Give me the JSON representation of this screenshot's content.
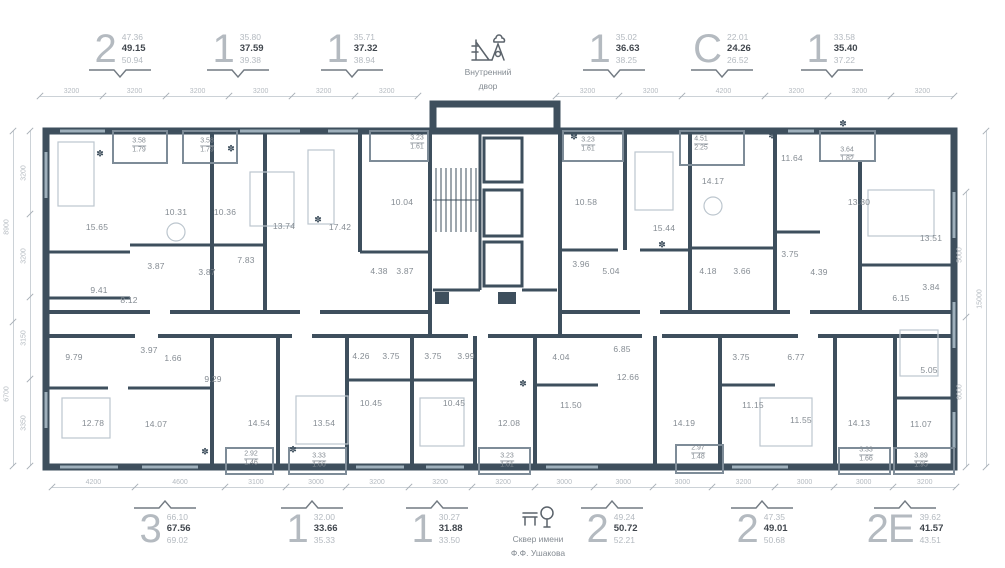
{
  "colors": {
    "wall": "#3e4f5d",
    "window": "#9fb0bc",
    "dim_line": "#ccd2d7",
    "dim_text": "#b5bbc1",
    "room_text": "#858c93",
    "unit_digit": "#b4bac0",
    "unit_bold": "#41474e"
  },
  "plant_glyph": "✽",
  "courtyard": {
    "line1": "Внутренний",
    "line2": "двор"
  },
  "park": {
    "line1": "Сквер имени",
    "line2": "Ф.Ф. Ушакова"
  },
  "top_units": [
    {
      "type": "2",
      "values": [
        "47.36",
        "49.15",
        "50.94"
      ],
      "x": 120
    },
    {
      "type": "1",
      "values": [
        "35.80",
        "37.59",
        "39.38"
      ],
      "x": 238
    },
    {
      "type": "1",
      "values": [
        "35.71",
        "37.32",
        "38.94"
      ],
      "x": 352
    },
    {
      "type": "1",
      "values": [
        "35.02",
        "36.63",
        "38.25"
      ],
      "x": 614
    },
    {
      "type": "С",
      "values": [
        "22.01",
        "24.26",
        "26.52"
      ],
      "x": 722
    },
    {
      "type": "1",
      "values": [
        "33.58",
        "35.40",
        "37.22"
      ],
      "x": 832
    }
  ],
  "bottom_units": [
    {
      "type": "3",
      "values": [
        "66.10",
        "67.56",
        "69.02"
      ],
      "x": 165
    },
    {
      "type": "1",
      "values": [
        "32.00",
        "33.66",
        "35.33"
      ],
      "x": 312
    },
    {
      "type": "1",
      "values": [
        "30.27",
        "31.88",
        "33.50"
      ],
      "x": 437
    },
    {
      "type": "2",
      "values": [
        "49.24",
        "50.72",
        "52.21"
      ],
      "x": 612
    },
    {
      "type": "2",
      "values": [
        "47.35",
        "49.01",
        "50.68"
      ],
      "x": 762
    },
    {
      "type": "2Е",
      "values": [
        "39.62",
        "41.57",
        "43.51"
      ],
      "x": 905
    }
  ],
  "rooms": [
    {
      "v": "15.65",
      "x": 97,
      "y": 227
    },
    {
      "v": "10.31",
      "x": 176,
      "y": 212
    },
    {
      "v": "10.36",
      "x": 225,
      "y": 212
    },
    {
      "v": "3.87",
      "x": 156,
      "y": 266
    },
    {
      "v": "3.87",
      "x": 207,
      "y": 272
    },
    {
      "v": "7.83",
      "x": 246,
      "y": 260
    },
    {
      "v": "9.41",
      "x": 99,
      "y": 290
    },
    {
      "v": "8.12",
      "x": 129,
      "y": 300
    },
    {
      "v": "13.74",
      "x": 284,
      "y": 226
    },
    {
      "v": "17.42",
      "x": 340,
      "y": 227
    },
    {
      "v": "10.04",
      "x": 402,
      "y": 202
    },
    {
      "v": "4.38",
      "x": 379,
      "y": 271
    },
    {
      "v": "3.87",
      "x": 405,
      "y": 271
    },
    {
      "v": "10.58",
      "x": 586,
      "y": 202
    },
    {
      "v": "15.44",
      "x": 664,
      "y": 228
    },
    {
      "v": "3.96",
      "x": 581,
      "y": 264
    },
    {
      "v": "5.04",
      "x": 611,
      "y": 271
    },
    {
      "v": "14.17",
      "x": 713,
      "y": 181
    },
    {
      "v": "4.18",
      "x": 708,
      "y": 271
    },
    {
      "v": "3.66",
      "x": 742,
      "y": 271
    },
    {
      "v": "3.75",
      "x": 790,
      "y": 254
    },
    {
      "v": "4.39",
      "x": 819,
      "y": 272
    },
    {
      "v": "11.64",
      "x": 792,
      "y": 158
    },
    {
      "v": "13.80",
      "x": 859,
      "y": 202
    },
    {
      "v": "13.51",
      "x": 931,
      "y": 238
    },
    {
      "v": "3.84",
      "x": 931,
      "y": 287
    },
    {
      "v": "6.15",
      "x": 901,
      "y": 298
    },
    {
      "v": "9.79",
      "x": 74,
      "y": 357
    },
    {
      "v": "3.97",
      "x": 149,
      "y": 350
    },
    {
      "v": "1.66",
      "x": 173,
      "y": 358
    },
    {
      "v": "9.29",
      "x": 213,
      "y": 379
    },
    {
      "v": "12.78",
      "x": 93,
      "y": 423
    },
    {
      "v": "14.07",
      "x": 156,
      "y": 424
    },
    {
      "v": "14.54",
      "x": 259,
      "y": 423
    },
    {
      "v": "13.54",
      "x": 324,
      "y": 423
    },
    {
      "v": "4.26",
      "x": 361,
      "y": 356
    },
    {
      "v": "3.75",
      "x": 391,
      "y": 356
    },
    {
      "v": "3.75",
      "x": 433,
      "y": 356
    },
    {
      "v": "3.99",
      "x": 466,
      "y": 356
    },
    {
      "v": "10.45",
      "x": 371,
      "y": 403
    },
    {
      "v": "10.45",
      "x": 454,
      "y": 403
    },
    {
      "v": "12.08",
      "x": 509,
      "y": 423
    },
    {
      "v": "4.04",
      "x": 561,
      "y": 357
    },
    {
      "v": "11.50",
      "x": 571,
      "y": 405
    },
    {
      "v": "6.85",
      "x": 622,
      "y": 349
    },
    {
      "v": "12.66",
      "x": 628,
      "y": 377
    },
    {
      "v": "14.19",
      "x": 684,
      "y": 423
    },
    {
      "v": "3.75",
      "x": 741,
      "y": 357
    },
    {
      "v": "11.15",
      "x": 753,
      "y": 405
    },
    {
      "v": "6.77",
      "x": 796,
      "y": 357
    },
    {
      "v": "11.55",
      "x": 801,
      "y": 420
    },
    {
      "v": "14.13",
      "x": 859,
      "y": 423
    },
    {
      "v": "5.05",
      "x": 929,
      "y": 370
    },
    {
      "v": "11.07",
      "x": 921,
      "y": 424
    }
  ],
  "balconies": [
    {
      "t": "3.58",
      "b": "1.79",
      "x": 139,
      "y": 146
    },
    {
      "t": "3.58",
      "b": "1.79",
      "x": 207,
      "y": 146
    },
    {
      "t": "3.23",
      "b": "1.61",
      "x": 417,
      "y": 143
    },
    {
      "t": "3.23",
      "b": "1.61",
      "x": 588,
      "y": 145
    },
    {
      "t": "4.51",
      "b": "2.25",
      "x": 701,
      "y": 144
    },
    {
      "t": "3.64",
      "b": "1.82",
      "x": 847,
      "y": 155
    },
    {
      "t": "2.92",
      "b": "1.46",
      "x": 251,
      "y": 459
    },
    {
      "t": "3.33",
      "b": "1.66",
      "x": 319,
      "y": 461
    },
    {
      "t": "3.23",
      "b": "1.61",
      "x": 507,
      "y": 461
    },
    {
      "t": "2.97",
      "b": "1.48",
      "x": 698,
      "y": 453
    },
    {
      "t": "3.33",
      "b": "1.66",
      "x": 866,
      "y": 455
    },
    {
      "t": "3.89",
      "b": "1.95",
      "x": 921,
      "y": 461
    }
  ],
  "dim_chains": [
    {
      "name": "top-left",
      "dir": "h",
      "x": 40,
      "y": 96,
      "scale": 0.0197,
      "values": [
        3200,
        3200,
        3200,
        3200,
        3200,
        3200
      ]
    },
    {
      "name": "top-right",
      "dir": "h",
      "x": 556,
      "y": 96,
      "scale": 0.0197,
      "values": [
        3200,
        3200,
        4200,
        3200,
        3200,
        3200
      ]
    },
    {
      "name": "bottom",
      "dir": "h",
      "x": 52,
      "y": 487,
      "scale": 0.0197,
      "values": [
        4200,
        4600,
        3100,
        3000,
        3200,
        3200,
        3200,
        3000,
        3000,
        3000,
        3200,
        3000,
        3000,
        3200
      ]
    },
    {
      "name": "left-outer",
      "dir": "v",
      "x": 13,
      "y": 131,
      "scale": 0.0215,
      "values": [
        8900,
        6700
      ]
    },
    {
      "name": "left-inner",
      "dir": "v",
      "x": 30,
      "y": 131,
      "scale": 0.026,
      "values": [
        3200,
        3200,
        3150,
        3350
      ]
    },
    {
      "name": "right-inner",
      "dir": "v",
      "x": 966,
      "y": 192,
      "scale": 0.025,
      "values": [
        5000,
        6000
      ]
    },
    {
      "name": "right-outer",
      "dir": "v",
      "x": 986,
      "y": 131,
      "scale": 0.0224,
      "values": [
        15000
      ]
    }
  ],
  "plants": [
    {
      "x": 100,
      "y": 154
    },
    {
      "x": 231,
      "y": 149
    },
    {
      "x": 318,
      "y": 220
    },
    {
      "x": 574,
      "y": 137
    },
    {
      "x": 662,
      "y": 245
    },
    {
      "x": 772,
      "y": 136
    },
    {
      "x": 843,
      "y": 124
    },
    {
      "x": 205,
      "y": 452
    },
    {
      "x": 293,
      "y": 450
    },
    {
      "x": 523,
      "y": 384
    }
  ]
}
